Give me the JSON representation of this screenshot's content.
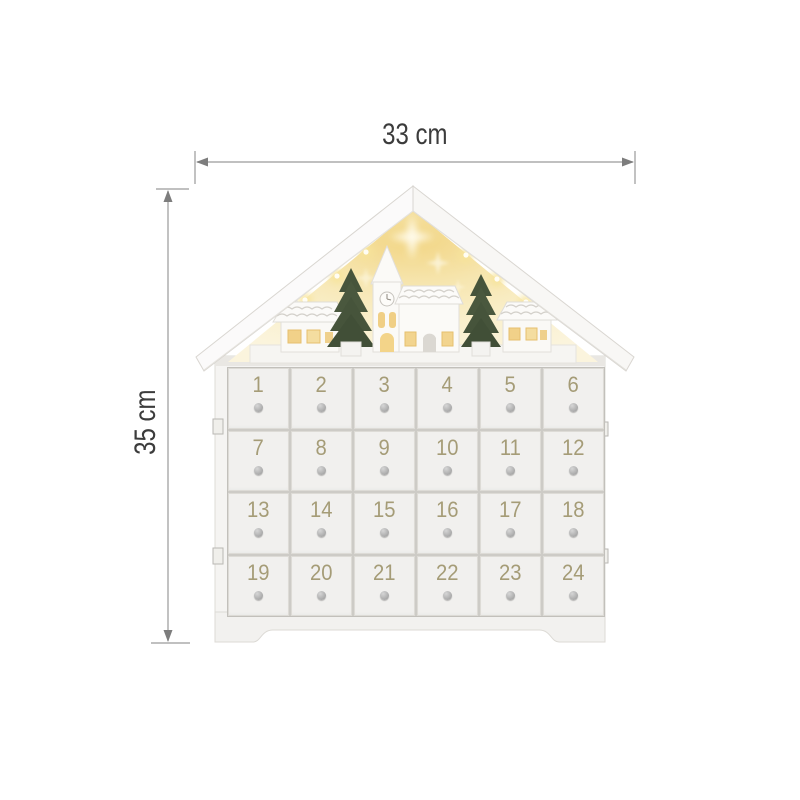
{
  "page": {
    "type": "product-dimension-image",
    "background": "#ffffff"
  },
  "annotations": {
    "width_label": "33 cm",
    "height_label": "35 cm"
  },
  "calendar": {
    "description": "white wooden house-shaped advent calendar with lit village scene in gable",
    "grid": {
      "rows": 4,
      "columns": 6
    },
    "drawers": [
      "1",
      "2",
      "3",
      "4",
      "5",
      "6",
      "7",
      "8",
      "9",
      "10",
      "11",
      "12",
      "13",
      "14",
      "15",
      "16",
      "17",
      "18",
      "19",
      "20",
      "21",
      "22",
      "23",
      "24"
    ]
  },
  "scene": {
    "elements": [
      "star-icon",
      "led-light-icon",
      "christmas-tree-icon",
      "church-icon",
      "house-icon",
      "ledge"
    ]
  },
  "colors": {
    "dimension_line": "#9a9a9a",
    "dimension_text": "#3c3c3c",
    "body_white": "#f5f4f2",
    "drawer_face": "#f1f0ee",
    "drawer_number": "#a59c77",
    "knob_gray": "#a0a0a0",
    "glow_warm": "#f3d98e",
    "tree_green": "#46543b",
    "window_warm": "#f0cf85"
  }
}
